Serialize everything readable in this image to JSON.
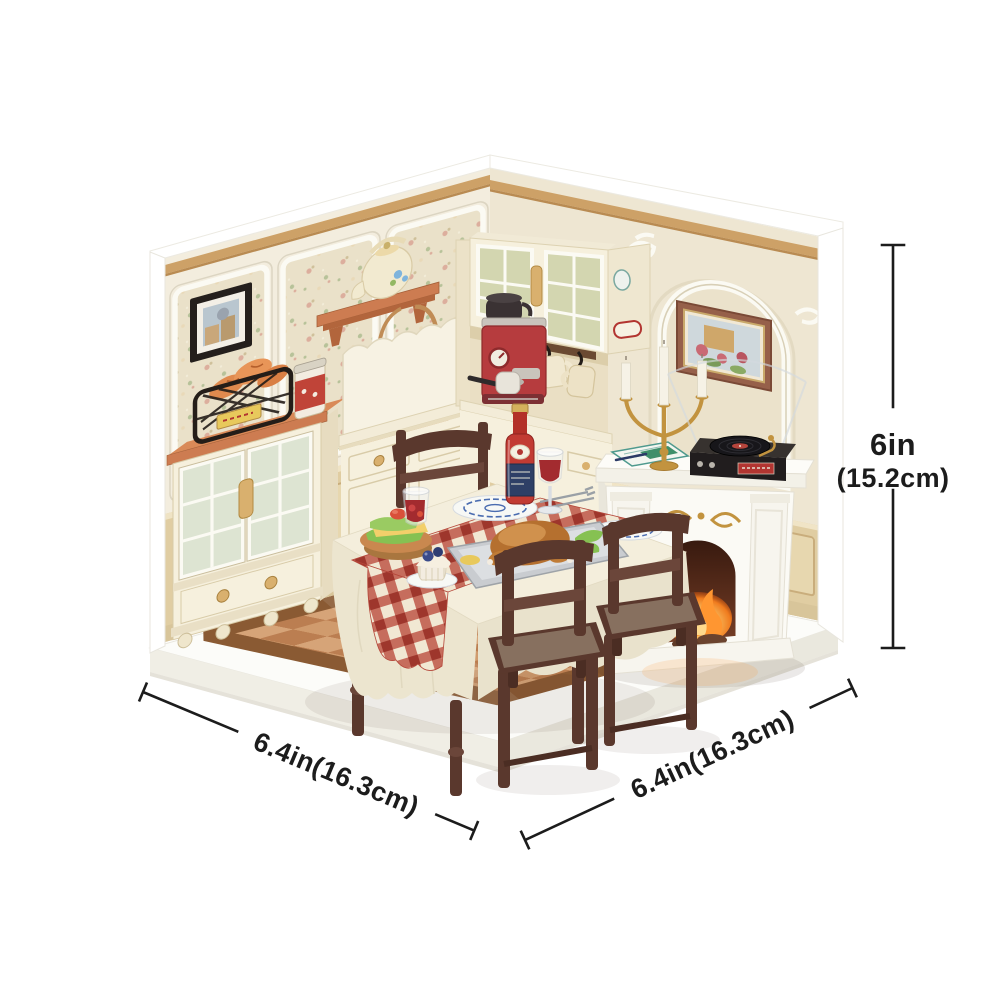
{
  "page": {
    "background": "#ffffff"
  },
  "annotations": {
    "height_in": "6in",
    "height_cm": "(15.2cm)",
    "depth_left": "6.4in(16.3cm)",
    "depth_right": "6.4in(16.3cm)"
  },
  "scene": {
    "kind": "miniature-dollhouse-dining-room-diorama",
    "objects": [
      "white-display-base",
      "terracotta-checker-floor",
      "wood-floor-border",
      "floral-wallpaper-panels",
      "panel-molding",
      "wood-wall-trim",
      "wainscoting",
      "black-framed-picture",
      "wall-shelf",
      "cream-teapot",
      "hanging-tote-bag",
      "glass-door-hutch",
      "wire-bread-basket",
      "red-storage-jar",
      "kitchen-counter",
      "scalloped-backsplash",
      "upper-glass-cabinet",
      "red-espresso-machine",
      "hanging-mugs",
      "gold-candelabra",
      "arched-niche",
      "framed-painting",
      "white-fireplace",
      "fireplace-fire",
      "vinyl-record-player",
      "sheet-papers",
      "dining-table",
      "white-tablecloth",
      "red-gingham-runner",
      "blue-pattern-plates",
      "roast-on-tray",
      "sandwich-stack",
      "blueberry-cupcake",
      "red-drink-glass",
      "wine-glass",
      "red-sauce-bottle",
      "wooden-dining-chairs"
    ]
  },
  "colors": {
    "pageBg": "#ffffff",
    "ink": "#1c1c1c",
    "wallCream": "#f3edde",
    "wallShade": "#eee6d2",
    "wallpaperBase": "#eae1c9",
    "moldingWhite": "#fbfaf3",
    "woodTrim": "#cda167",
    "terracotta": "#cd7c51",
    "cabinetCream": "#f6f0dd",
    "floorLight": "#d6a478",
    "floorDark": "#bb7e51",
    "floorBorder": "#8a5a33",
    "platformTop": "#fcfcf9",
    "platformSide": "#f0eee5",
    "chairWood": "#5a382d",
    "cushion": "#87705f",
    "cloth": "#f4eedc",
    "ginghamRed": "#bb4f40",
    "fireplaceWhite": "#fbfaf5",
    "gold": "#c2933f",
    "machineRed": "#b63c3e",
    "fireOrange": "#ff9631",
    "wineRed": "#a32b2f"
  }
}
